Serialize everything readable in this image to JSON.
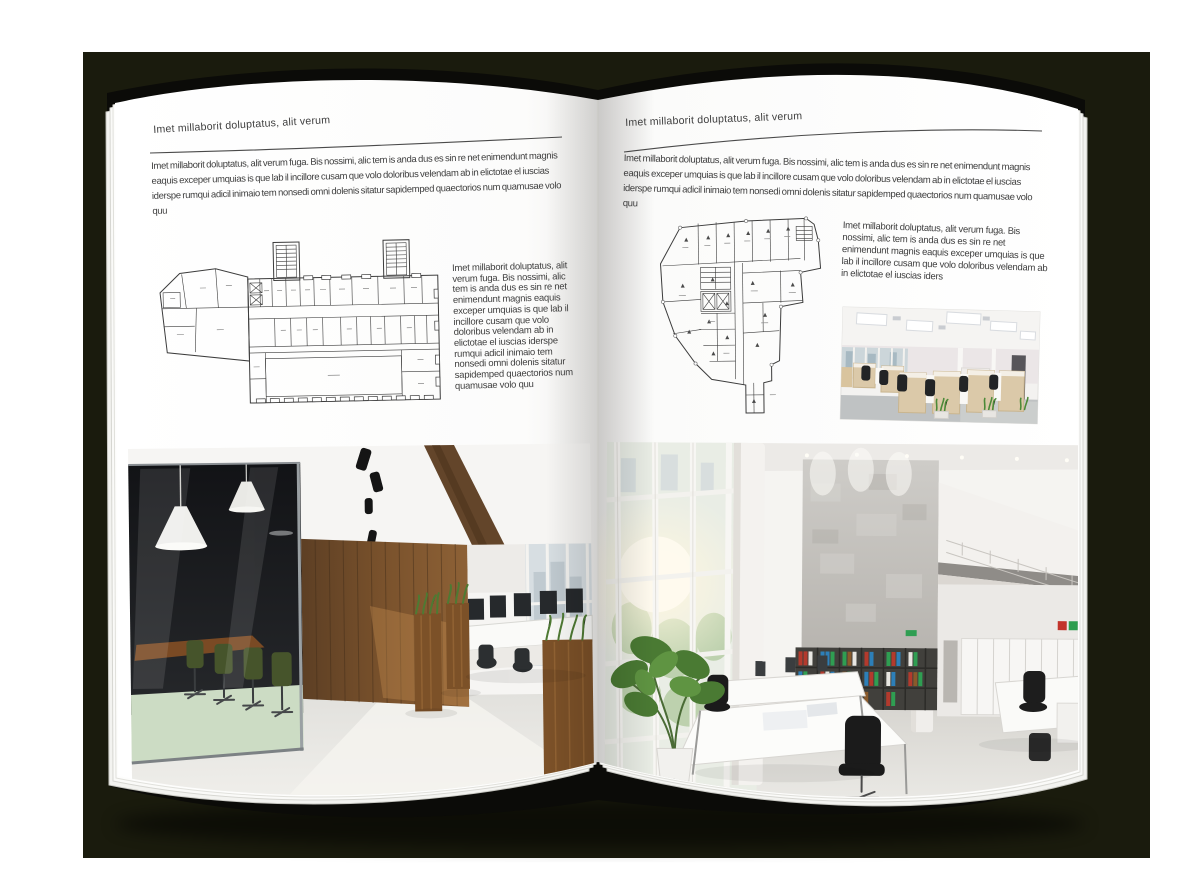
{
  "spread": {
    "kind": "open-magazine-architecture-brochure",
    "background_color": "#1a1b0d",
    "cover_color": "#0b0b08",
    "page_color": "#ffffff",
    "text_color": "#3e3e3e"
  },
  "left_page": {
    "header": "Imet millaborit doluptatus, alit verum",
    "intro": "Imet millaborit doluptatus, alit verum fuga. Bis nossimi, alic tem is anda dus es sin re net enimendunt magnis eaquis exceper umquias is que lab il incillore cusam que volo doloribus velendam ab in elictotae el iuscias iderspe rumqui adicil inimaio tem nonsedi omni dolenis sitatur sapidemped quaectorios num quamusae volo quu",
    "plan_side_text": "Imet millaborit doluptatus, alit verum fuga. Bis nossimi, alic tem is anda dus es sin re net enimendunt magnis eaquis exceper umquias is que lab il incillore cusam que volo doloribus velendam ab in elictotae el iuscias iderspe rumqui adicil inimaio tem nonsedi omni dolenis sitatur sapidemped quaectorios num quamusae volo quu",
    "figures": {
      "floor_plan": "rectangular-building-floor-plan-with-two-stair-towers",
      "photo": "office-interior-glass-meeting-room-wood-wall"
    }
  },
  "right_page": {
    "header": "Imet millaborit doluptatus, alit verum",
    "intro": "Imet millaborit doluptatus, alit verum fuga. Bis nossimi, alic tem is anda dus es sin re net enimendunt magnis eaquis exceper umquias is que lab il incillore cusam que volo doloribus velendam ab in elictotae el iuscias iderspe rumqui adicil inimaio tem nonsedi omni dolenis sitatur sapidemped quaectorios num quamusae volo quu",
    "side_paragraph": "Imet millaborit doluptatus, alit verum fuga. Bis nossimi, alic tem is anda dus es sin re net enimendunt magnis eaquis exceper umquias is que lab il incillore cusam que volo doloribus velendam ab in elictotae el iuscias iders",
    "figures": {
      "floor_plan": "irregular-building-floor-plan",
      "photo_small": "open-plan-office-workstations",
      "photo_large": "double-height-atrium-office"
    }
  }
}
